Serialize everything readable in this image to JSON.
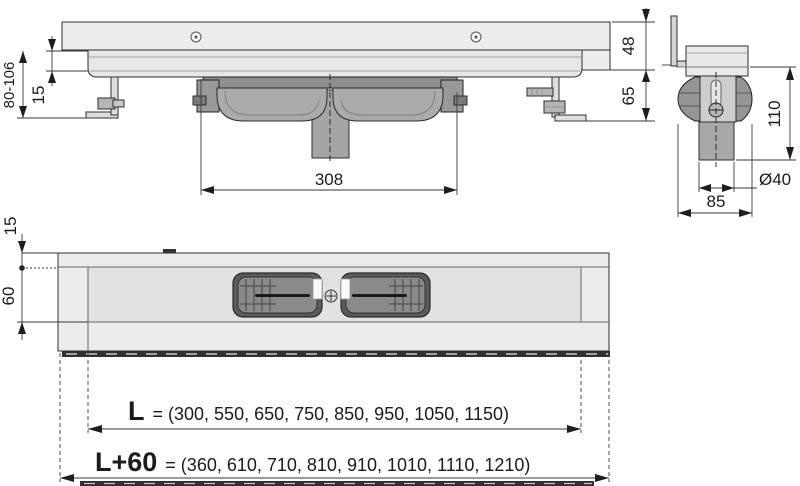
{
  "front_view": {
    "height_adjust": "80-106",
    "edge_offset": "15",
    "trap_body_width": "308",
    "channel_height": "48",
    "trap_depth": "65"
  },
  "side_view": {
    "install_height": "110",
    "outlet_diameter": "Ø40",
    "body_width": "85"
  },
  "plan_view": {
    "flange_depth": "15",
    "channel_width": "60",
    "length_row": {
      "label": "L",
      "values": "= (300, 550, 650, 750, 850, 950, 1050, 1150)"
    },
    "total_length_row": {
      "label": "L+60",
      "values": "= (360, 610, 710, 810, 910, 1010, 1110, 1210)"
    }
  }
}
